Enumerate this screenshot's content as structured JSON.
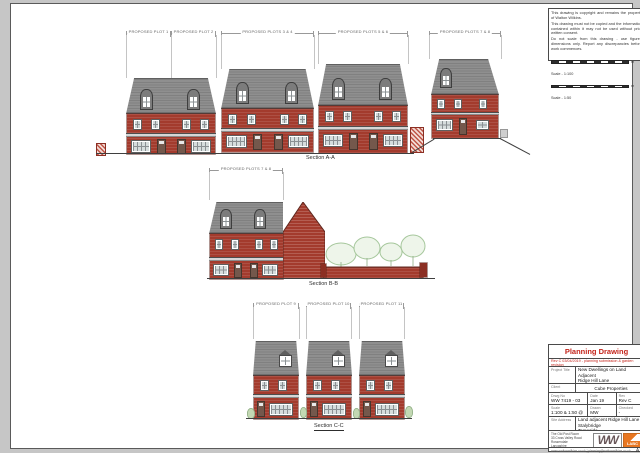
{
  "colors": {
    "brick": "#a33b2d",
    "roof": "#8f8f8f",
    "accent_red": "#c4241a",
    "landscape_green": "#a6c79c",
    "labc_orange": "#e87722"
  },
  "notes_panel": {
    "lines": [
      "This drawing is copyright and remains the property of Walton Wilkins.",
      "This drawing must not be copied and the information contained within it may not be used without prior written consent.",
      "Do not scale from this drawing - use figured dimensions only. Report any discrepancies before work commences."
    ],
    "scale_bars": [
      {
        "caption": "Scale - 1:100",
        "unit": "m"
      },
      {
        "caption": "Scale - 1:50",
        "unit": "m"
      }
    ]
  },
  "elevations": {
    "section_a": {
      "label": "Section A-A",
      "plot_labels": [
        "PROPOSED PLOT 1",
        "PROPOSED PLOT 2",
        "PROPOSED PLOTS 3 & 4",
        "PROPOSED PLOTS 5 & 6",
        "PROPOSED PLOTS 7 & 8"
      ]
    },
    "section_b": {
      "label": "Section B-B",
      "plot_labels": [
        "PROPOSED PLOTS 7 & 8"
      ]
    },
    "section_c": {
      "label": "Section C-C",
      "plot_labels": [
        "PROPOSED PLOT 9",
        "PROPOSED PLOT 10",
        "PROPOSED PLOT 11"
      ]
    }
  },
  "title_block": {
    "doc_type": "Planning Drawing",
    "revision_note": "Rev C 03/04/2019 - planning submission & garden revision",
    "project_title_label": "Project Title",
    "project_title_lines": [
      "New Dwellings on Land Adjacent",
      "Ridge Hill Lane",
      "Stalybridge, Tameside"
    ],
    "client_label": "Client",
    "client": "Cube Properties",
    "drwg_no_label": "Drwg No",
    "drwg_no": "WW 7419 - 03",
    "date_label": "Date",
    "date": "Jan 19",
    "rev_label": "Rev",
    "rev": "Rev C",
    "scale_label": "Scale",
    "scale": "1:100 & 1:50 @ A1",
    "drawn_label": "Drawn",
    "drawn": "MW",
    "checked_label": "Checked",
    "checked": "-",
    "site_address_label": "Site Address",
    "site_address_lines": [
      "Land adjacent Ridge Hill Lane",
      "Stalybridge",
      "Tameside"
    ],
    "company_lines": [
      "The Old Post Room",
      "33 Cross Valley Road",
      "Rossendale",
      "Lancashire",
      "BB4 7BX",
      "Tel: 01706 000 000"
    ],
    "footer_line": "www.waltonwilkins.co.uk  |  planning@waltonwilkins.co.uk",
    "paper_size": "A1",
    "logos": {
      "ww": "WW",
      "labc": "LABC"
    }
  }
}
